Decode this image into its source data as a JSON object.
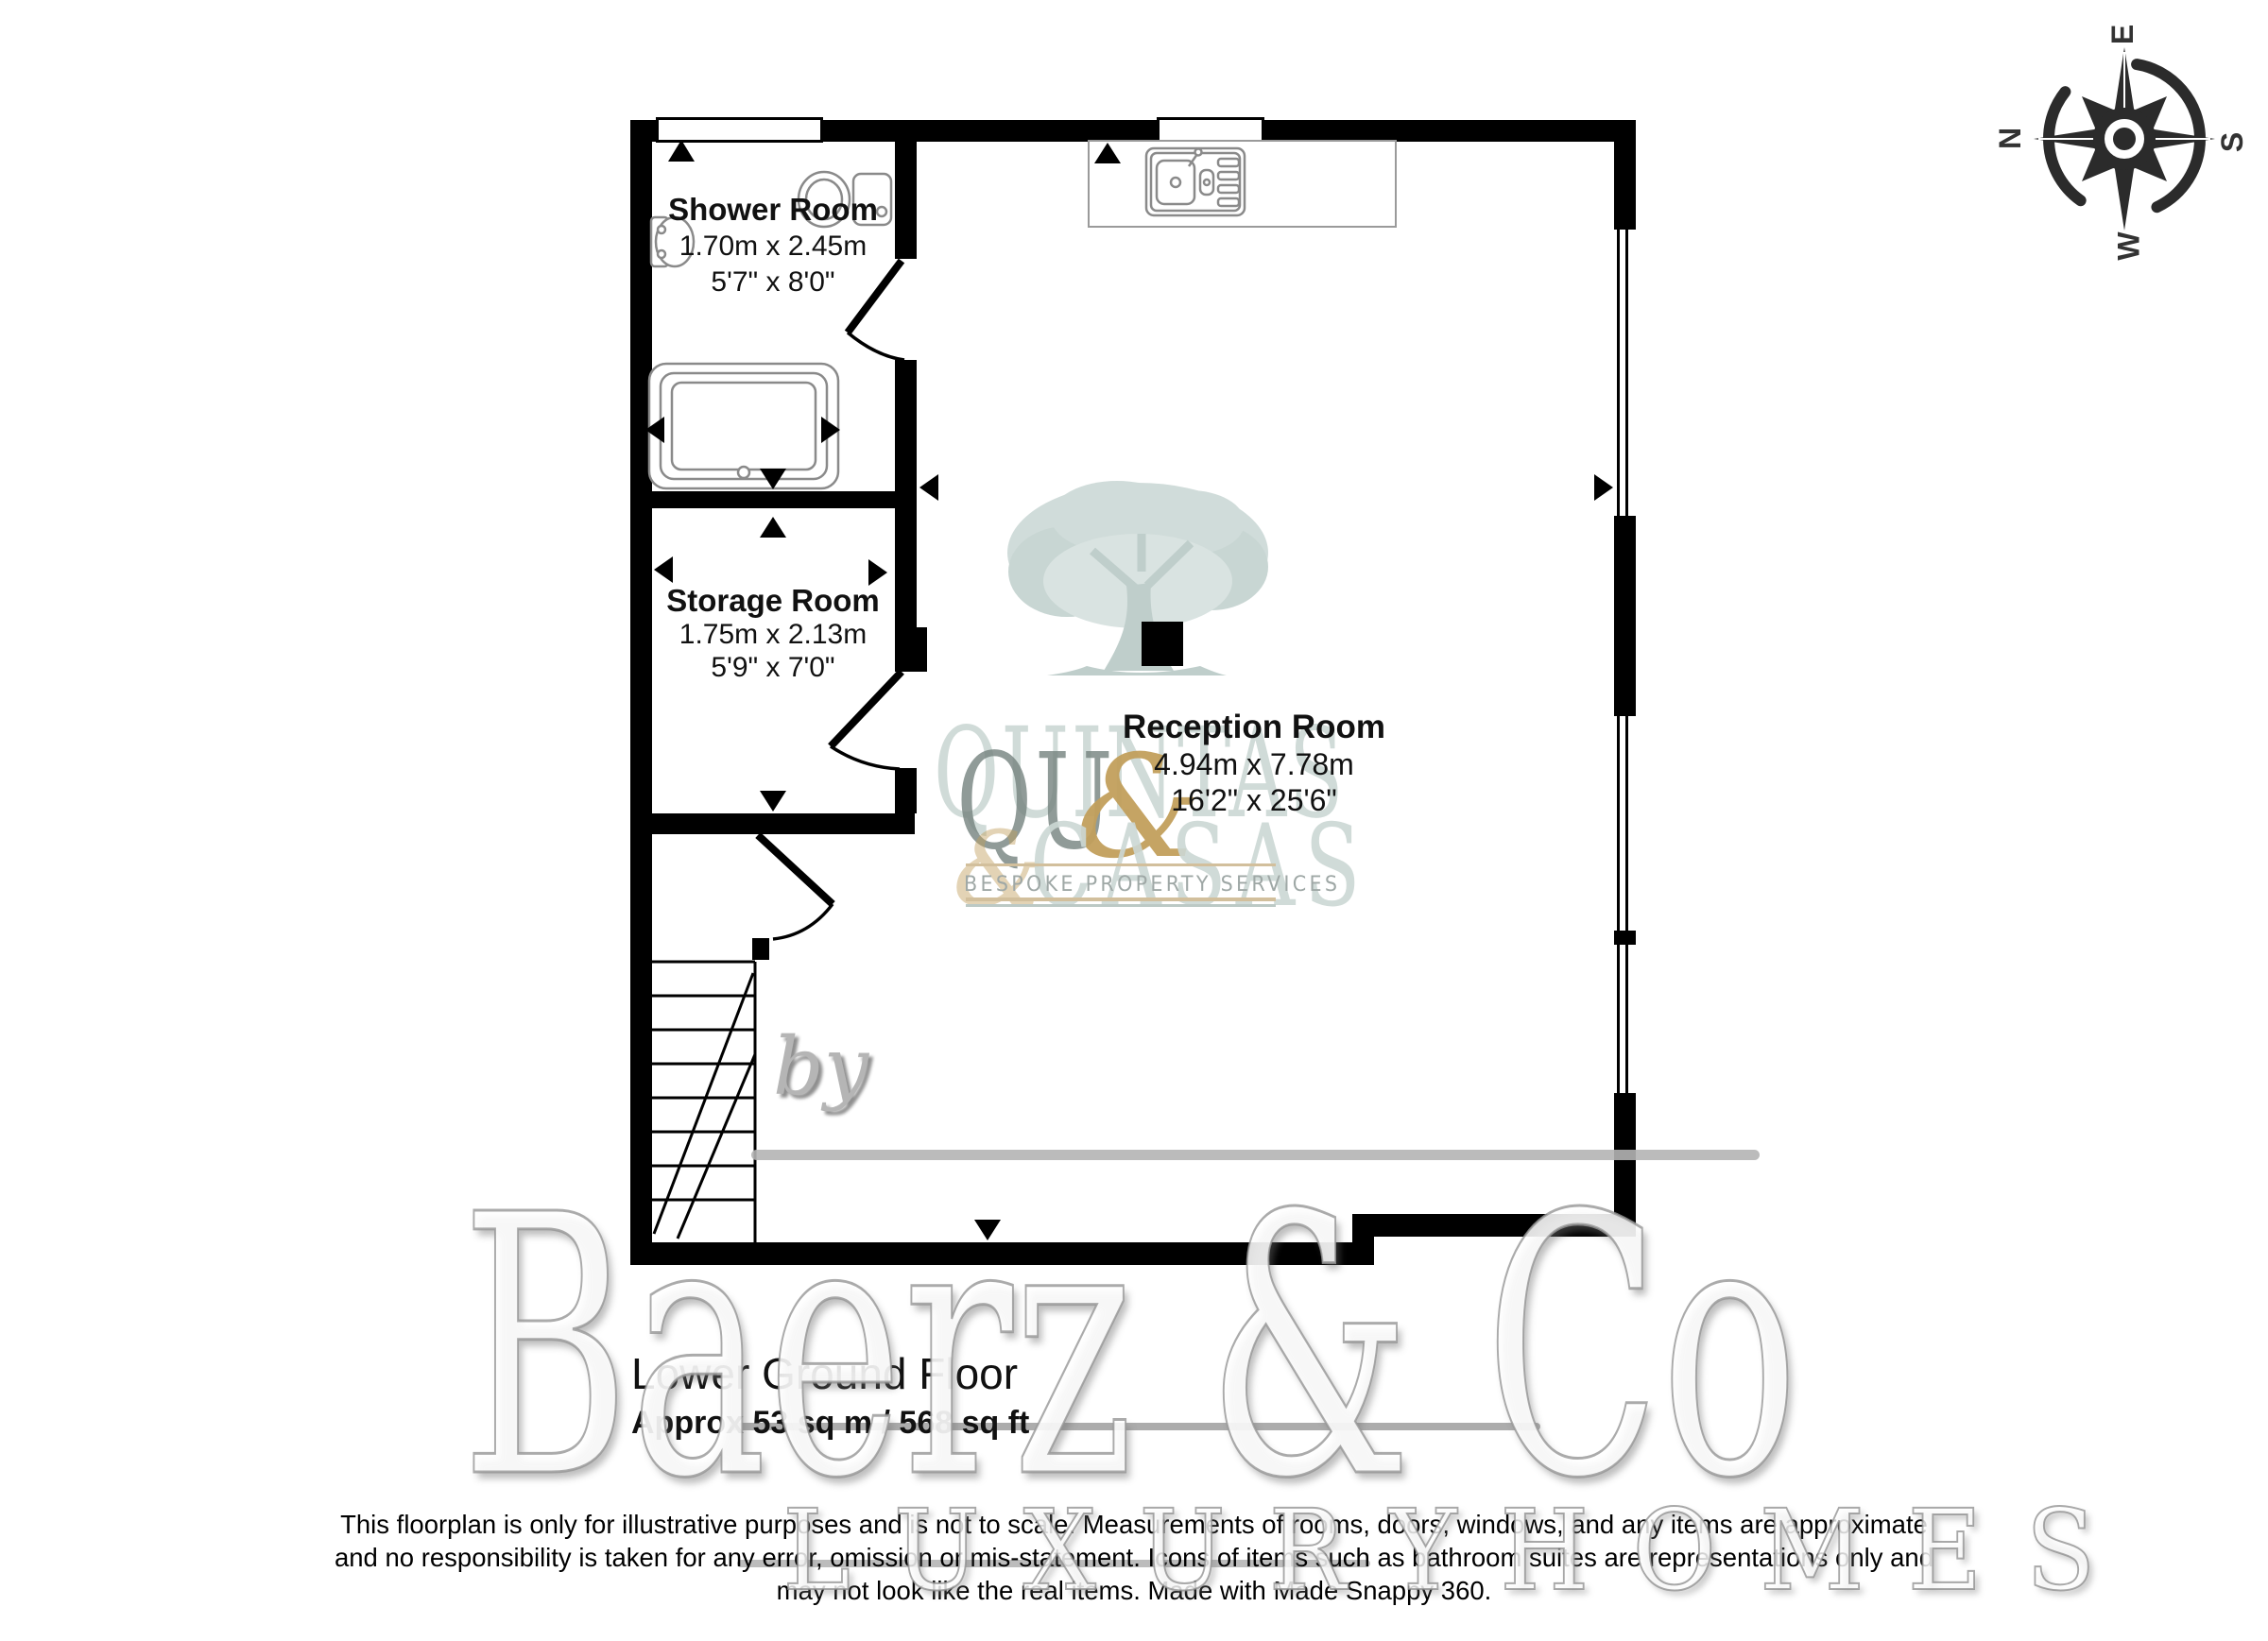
{
  "compass": {
    "top": "E",
    "left": "N",
    "right": "S",
    "bottom": "W"
  },
  "rooms": [
    {
      "name": "Shower Room",
      "metric": "1.70m x 2.45m",
      "imperial": "5'7\" x 8'0\""
    },
    {
      "name": "Storage Room",
      "metric": "1.75m x 2.13m",
      "imperial": "5'9\" x 7'0\""
    },
    {
      "name": "Reception Room",
      "metric": "4.94m x 7.78m",
      "imperial": "16'2\" x 25'6\""
    }
  ],
  "footer": {
    "floor_title": "Lower Ground Floor",
    "area": "Approx 53 sq m / 568 sq ft",
    "disclaimer_lines": [
      "This floorplan is only for illustrative purposes and is not to scale. Measurements of rooms, doors, windows, and any items are approximate",
      "and no responsibility is taken for any error, omission or mis-statement. Icons of items such as bathroom suites are representations only and",
      "may not look like the real items. Made with Made Snappy 360."
    ]
  },
  "watermarks": {
    "by": "by",
    "brand": "Baerz & Co",
    "brand_sub": "L U X U R Y   H O M E S",
    "logo_line1": "QUINTAS",
    "logo_line1_dark": "QU",
    "logo_amp": "&",
    "logo_line2": "CASAS",
    "logo_sub": "BESPOKE PROPERTY SERVICES"
  },
  "colors": {
    "wall": "#000000",
    "fixture_stroke": "#8a8a8a",
    "tree": "#ccd9d6",
    "gold": "#c2a05c",
    "logo_pale": "#ccd8d4",
    "compass": "#2b2b2b"
  }
}
